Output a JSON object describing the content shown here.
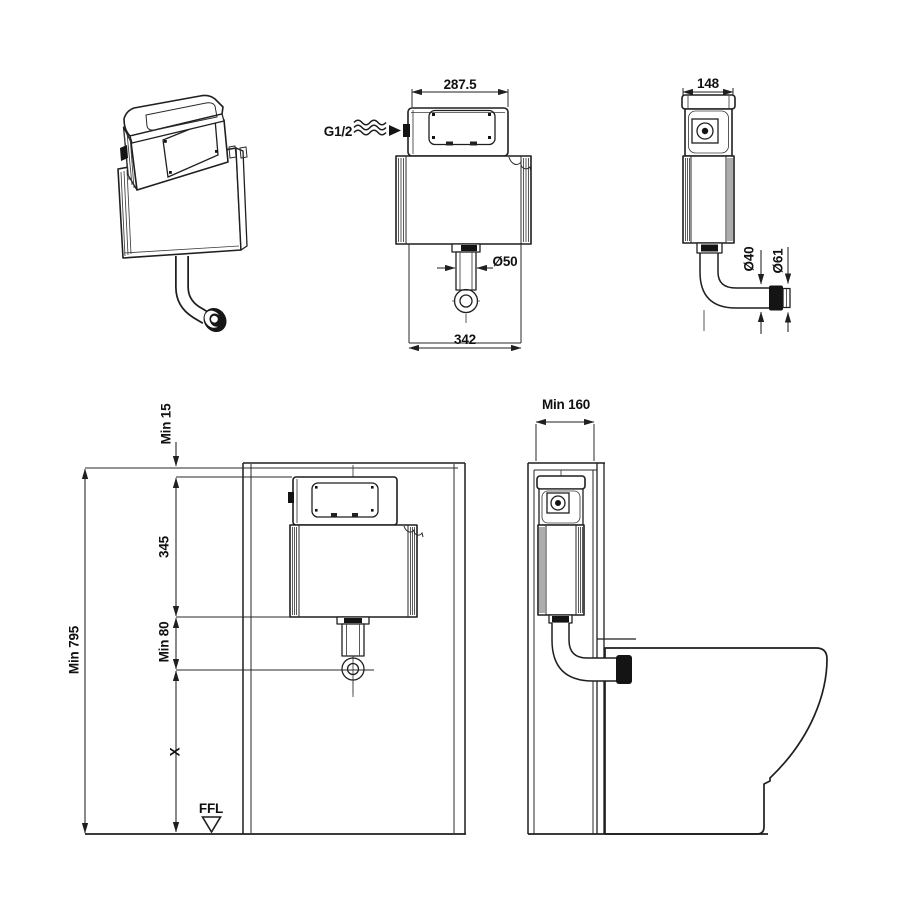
{
  "colors": {
    "line": "#1f1f1f",
    "background": "#ffffff"
  },
  "views": {
    "front": {
      "dim_top_width": "287.5",
      "dim_bottom_width": "342",
      "dim_outlet_diameter": "Ø50",
      "inlet_label": "G1/2"
    },
    "side": {
      "dim_depth": "148",
      "dim_pipe_diameter": "Ø40",
      "dim_connector_diameter": "Ø61"
    },
    "install_front": {
      "dim_top_clearance": "Min 15",
      "dim_cistern_height": "345",
      "dim_outlet_height": "Min 80",
      "dim_total_height": "Min 795",
      "dim_variable_height": "X",
      "floor_level_label": "FFL"
    },
    "install_side": {
      "dim_wall_depth": "Min 160"
    }
  }
}
